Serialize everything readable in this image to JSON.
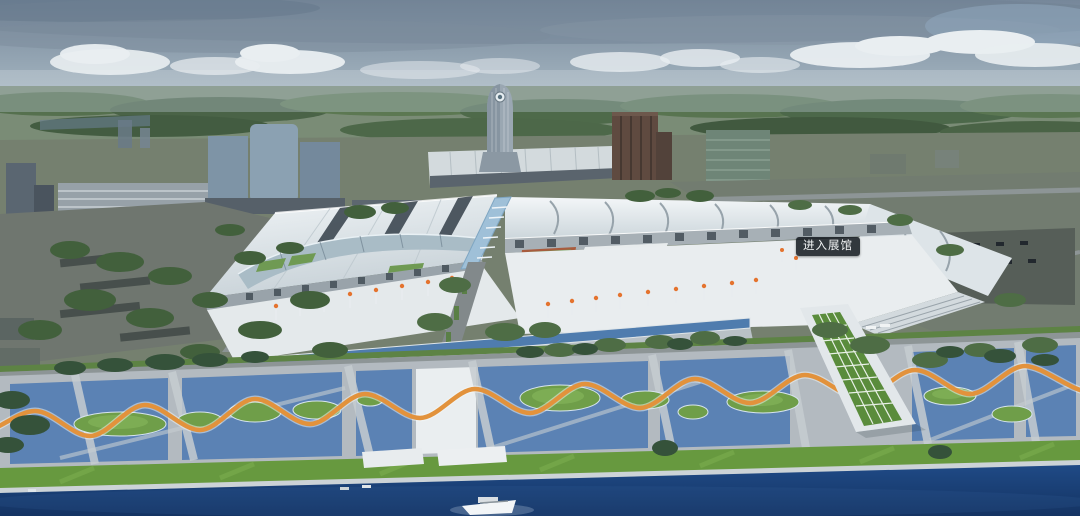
{
  "hotspot": {
    "label": "进入展馆"
  },
  "palette": {
    "sky_top": "#76879a",
    "sky_horizon": "#ccd6da",
    "cloud_white": "#e9eef1",
    "treeline_green": "#5c7452",
    "roof_white": "#e9eef0",
    "paving_blue": "#5b82b4",
    "ribbon_orange": "#e2923c",
    "lawn_green": "#67993f",
    "river_blue": "#1f4a86",
    "lamp_orange": "#e4732e",
    "hotspot_background": "#171d23",
    "hotspot_text": "#f2f4f5"
  }
}
